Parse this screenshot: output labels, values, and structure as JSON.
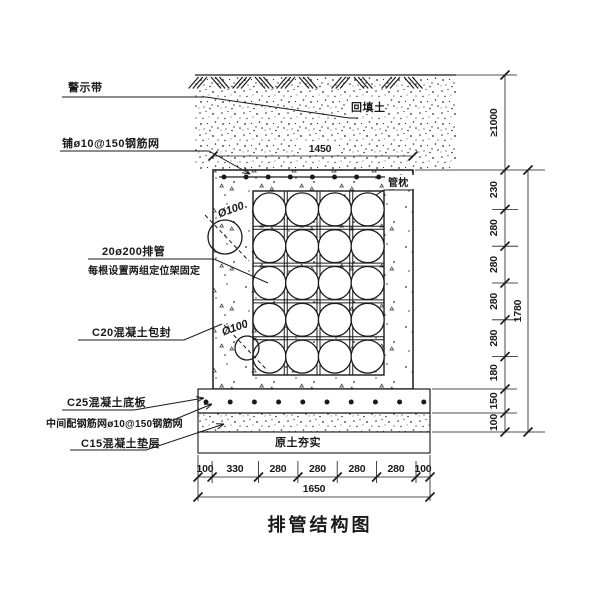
{
  "title": "排管结构图",
  "labels": {
    "warning_tape": "警示带",
    "backfill_soil": "回填土",
    "top_mesh": "铺ø10@150钢筋网",
    "pipe_sleeper": "管枕",
    "pipe_spec_line1": "20ø200排管",
    "pipe_spec_line2": "每根设置两组定位架固定",
    "encasement": "C20混凝土包封",
    "pipe_dia_upper": "Ø100",
    "pipe_dia_lower": "Ø100",
    "base_plate": "C25混凝土底板",
    "middle_mesh": "中间配钢筋网ø10@150钢筋网",
    "cushion": "C15混凝土垫层",
    "compacted_soil": "原土夯实"
  },
  "dimensions": {
    "top_width": "1450",
    "right": {
      "cover_depth": "≥1000",
      "segments": [
        "230",
        "280",
        "280",
        "280",
        "280",
        "180",
        "150",
        "100"
      ],
      "total": "1780"
    },
    "bottom": {
      "segments": [
        "100",
        "330",
        "280",
        "280",
        "280",
        "280",
        "100"
      ],
      "total": "1650"
    }
  },
  "colors": {
    "line": "#1a1a1a",
    "background": "#ffffff"
  }
}
